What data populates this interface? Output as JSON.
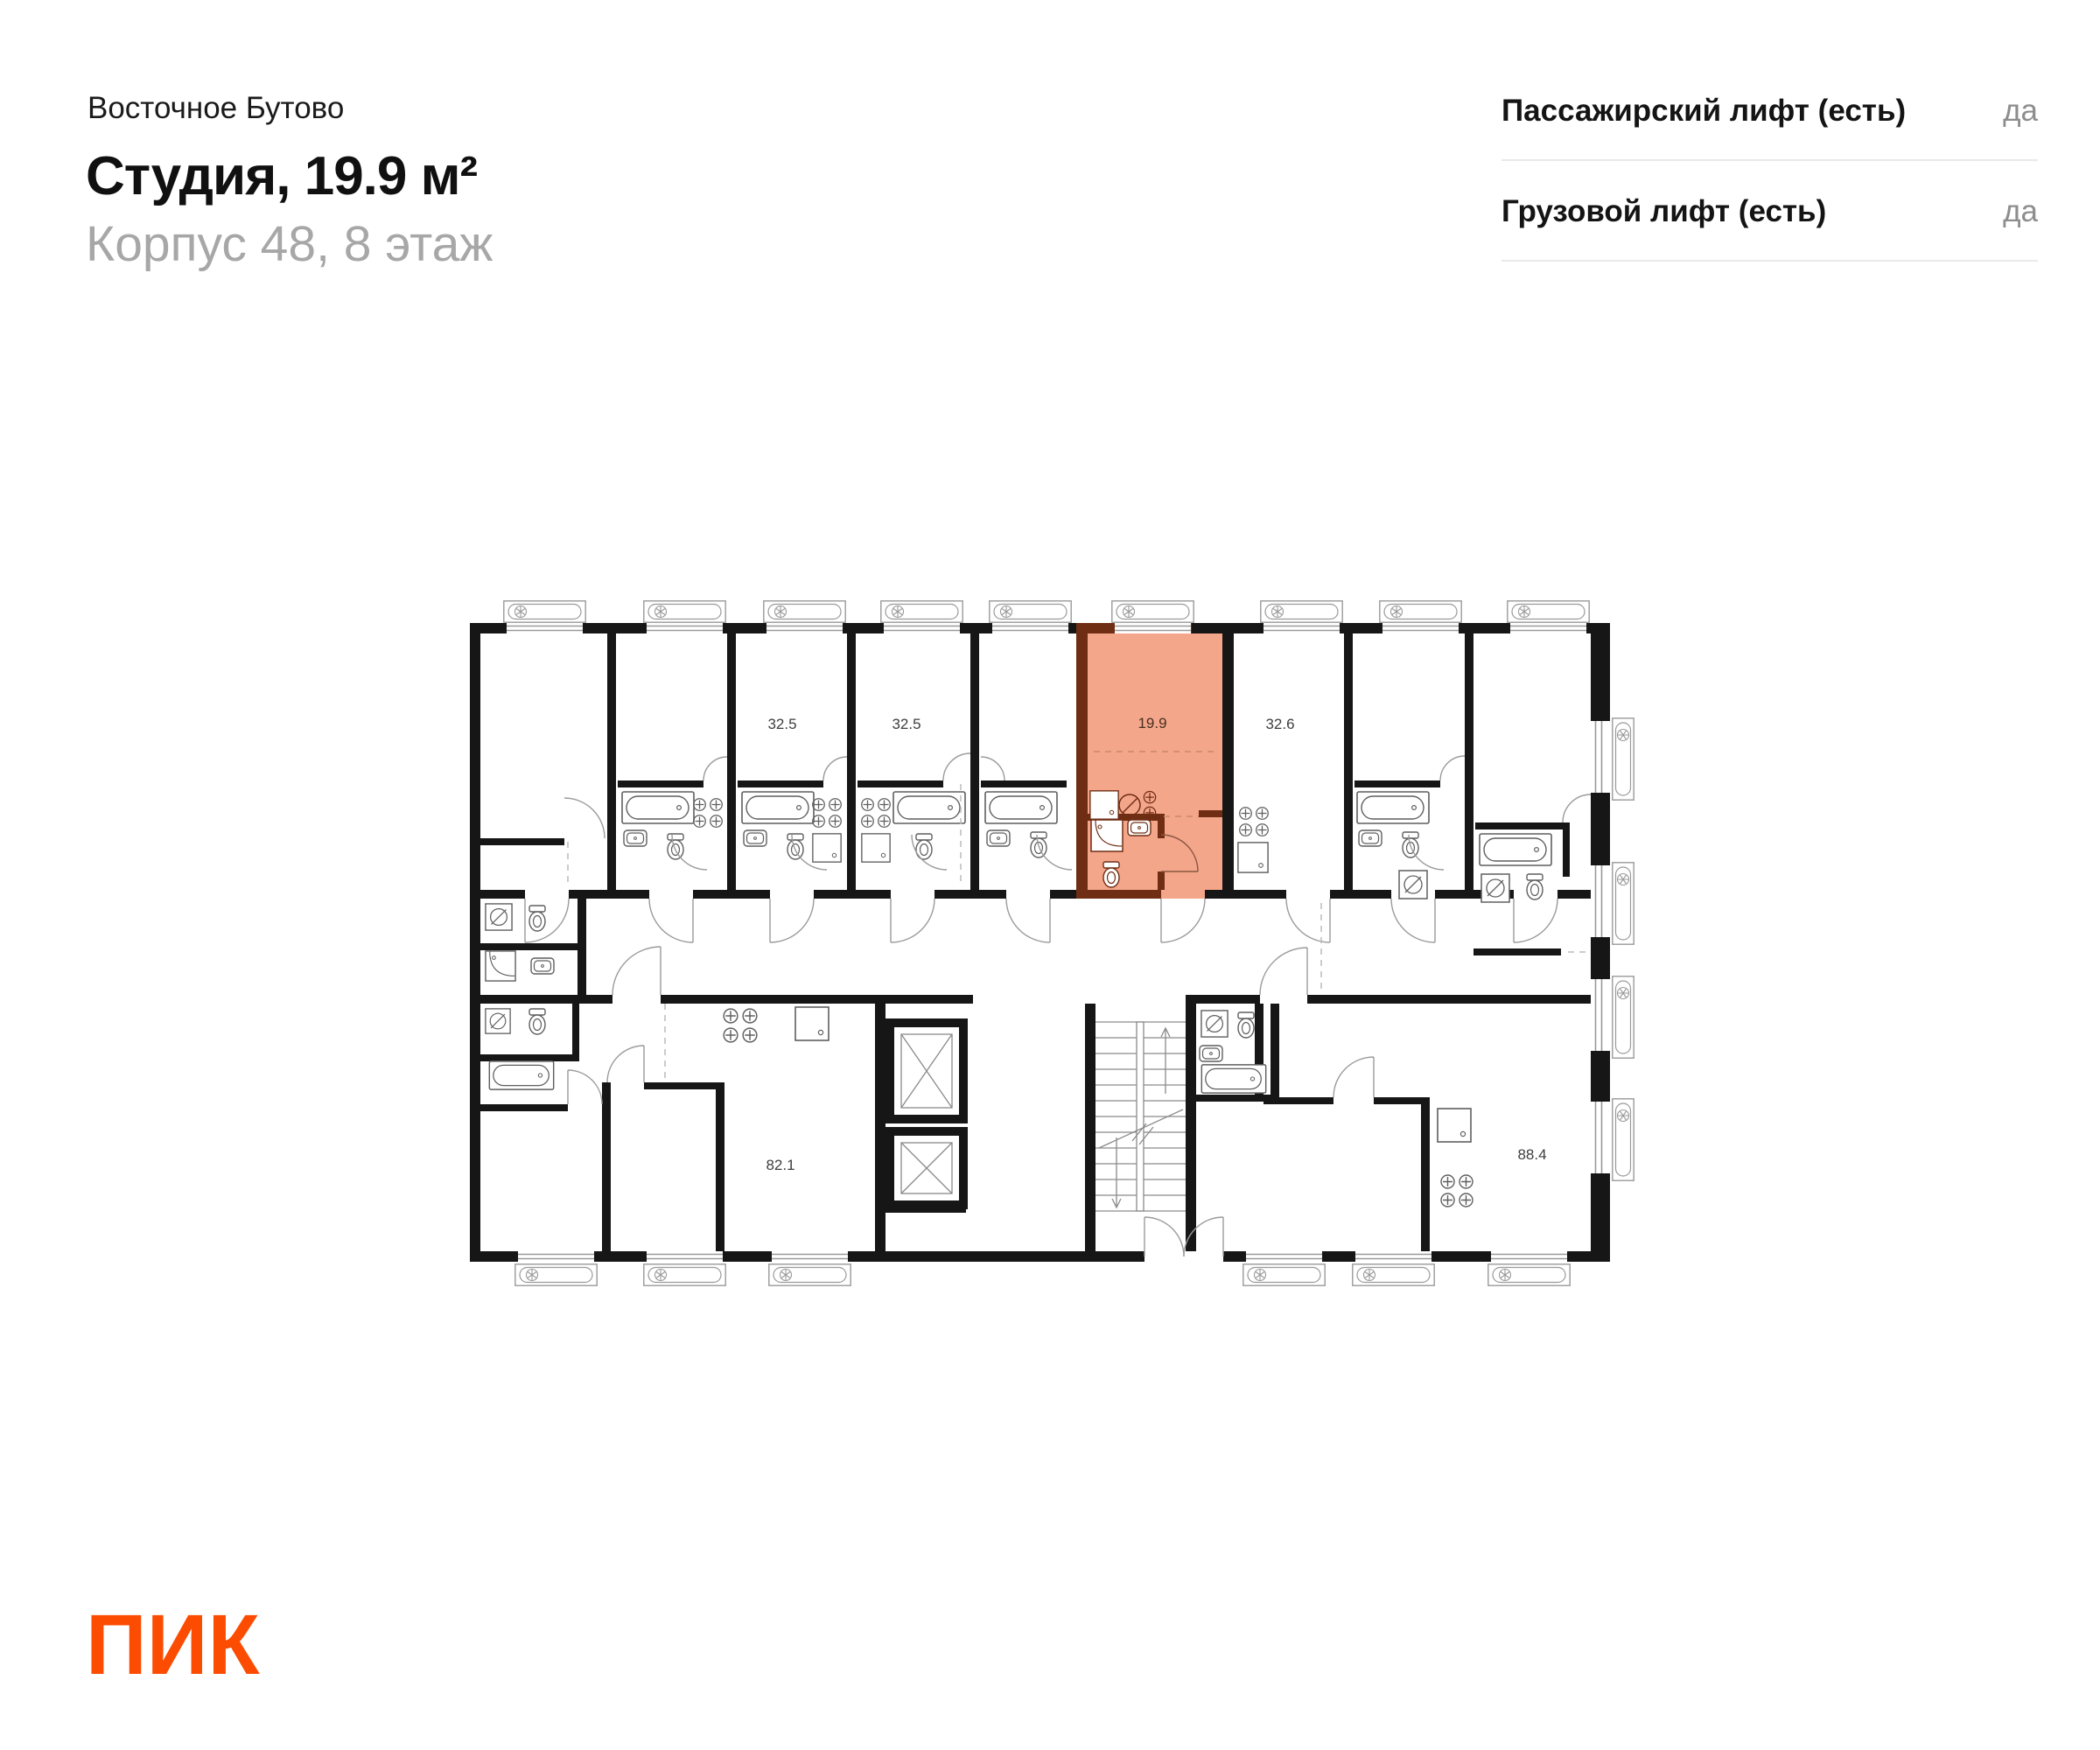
{
  "header": {
    "project": "Восточное Бутово",
    "title": "Студия, 19.9 м²",
    "subtitle": "Корпус 48, 8 этаж"
  },
  "lifts": {
    "rows": [
      {
        "label": "Пассажирский лифт (есть)",
        "value": "да"
      },
      {
        "label": "Грузовой лифт (есть)",
        "value": "да"
      }
    ]
  },
  "plan": {
    "highlight": {
      "area": "19.9",
      "fill": "#f4a68b",
      "wall": "#6f2d14"
    },
    "areas": {
      "unit_32_5_a": "32.5",
      "unit_32_5_b": "32.5",
      "unit_studio": "19.9",
      "unit_32_6": "32.6",
      "unit_82_1": "82.1",
      "unit_88_4": "88.4"
    },
    "wall_color": "#161616"
  },
  "footer": {
    "logo": "ПИК",
    "logo_color": "#fc4c02"
  }
}
